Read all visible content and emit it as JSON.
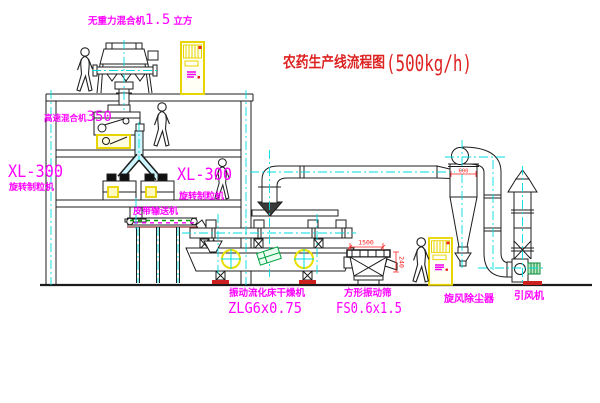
{
  "diagram": {
    "title": "农药生产线流程图",
    "capacity": "(500kg/h)"
  },
  "equipment": {
    "gravity_mixer": {
      "name": "无重力混合机",
      "size": "1.5",
      "unit": "立方"
    },
    "high_speed_mixer": {
      "name": "高速混合机",
      "model": "350"
    },
    "granulator_left": {
      "model": "XL-300",
      "name": "旋转制粒机"
    },
    "granulator_right": {
      "model": "XL-300",
      "name": "旋转制粒机"
    },
    "belt_conveyor": {
      "name": "皮带输送机"
    },
    "fluid_bed_dryer": {
      "name": "振动流化床干燥机",
      "model": "ZLG6x0.75"
    },
    "vibrating_sieve": {
      "name": "方形振动筛",
      "model": "FS0.6x1.5"
    },
    "cyclone": {
      "name": "旋风除尘器"
    },
    "induced_draft_fan": {
      "name": "引风机"
    }
  },
  "dimensions": {
    "sieve_length": "1500",
    "sieve_outlet_height": "240",
    "cyclone_inlet": "600"
  },
  "colors": {
    "label_magenta": "#ff00ff",
    "title_red": "#dd2222",
    "highlight_yellow": "#e8d400",
    "centerline_cyan": "#00dede",
    "dimension_red": "#ff2020",
    "drawing_black": "#1c1c1c",
    "motor_green": "#00a040"
  }
}
